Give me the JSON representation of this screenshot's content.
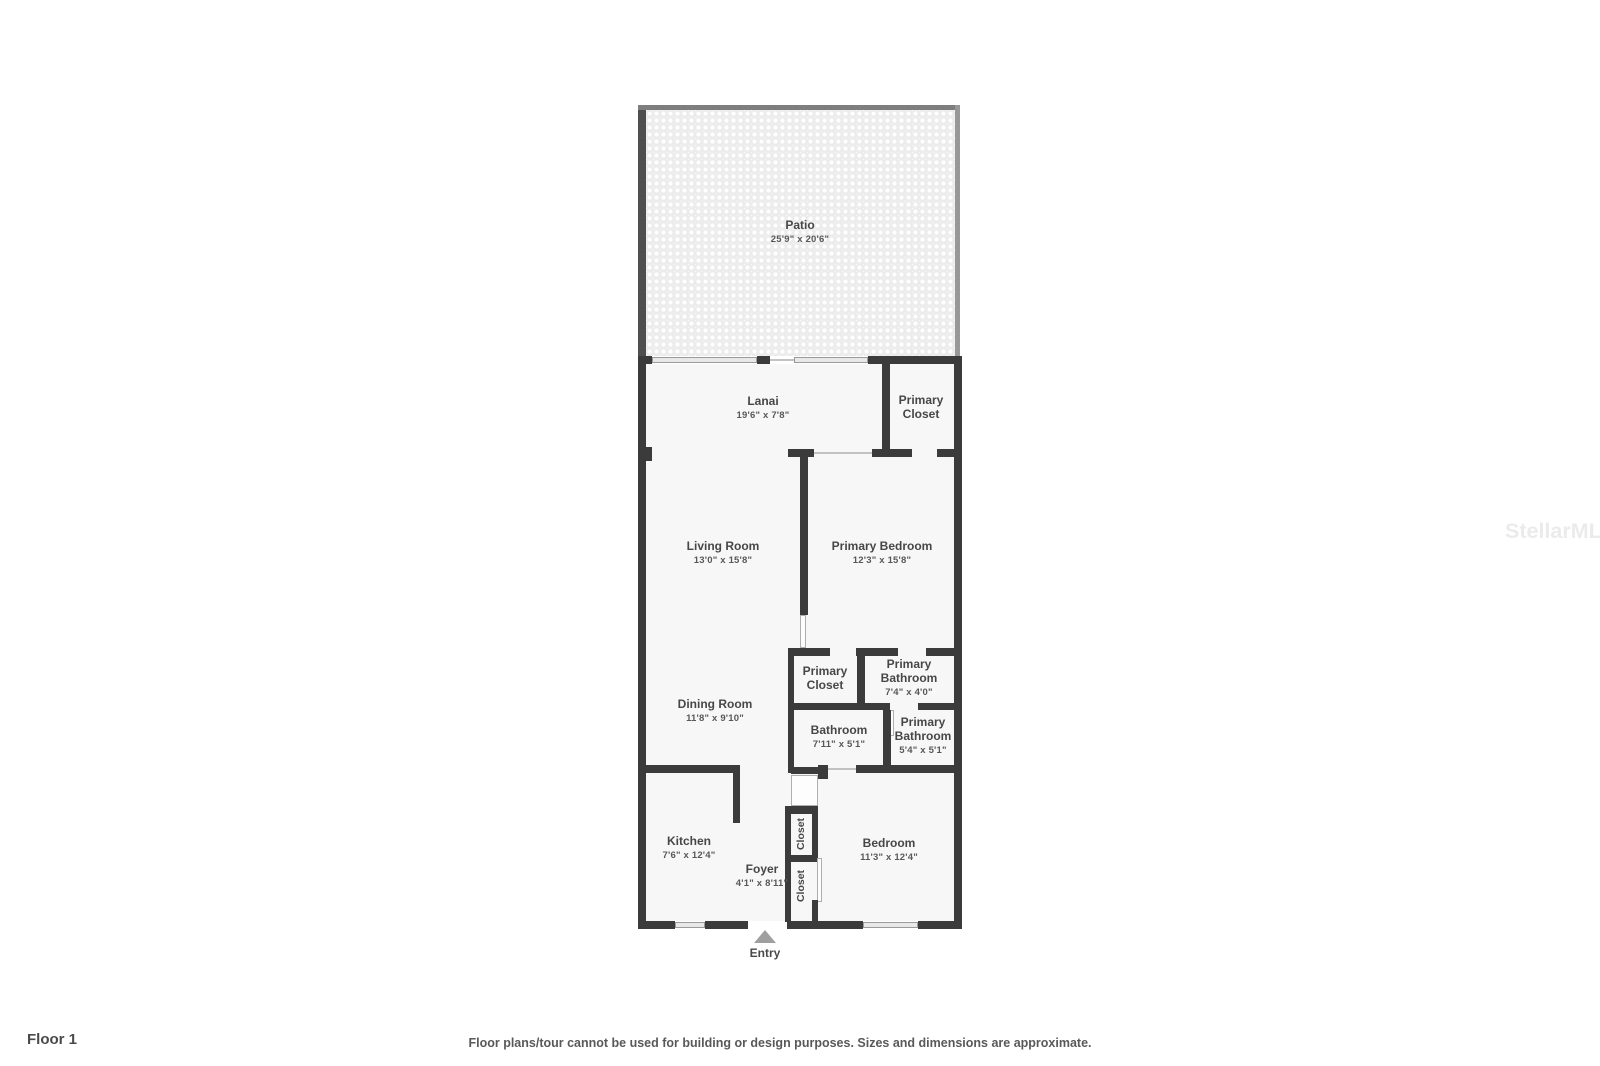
{
  "floor_label": "Floor 1",
  "disclaimer": "Floor plans/tour cannot be used for building or design purposes. Sizes and dimensions are approximate.",
  "watermark": "StellarMLS",
  "entry": {
    "label": "Entry"
  },
  "rooms": {
    "patio": {
      "name": "Patio",
      "dims": "25'9\" x 20'6\""
    },
    "lanai": {
      "name": "Lanai",
      "dims": "19'6\" x 7'8\""
    },
    "primary_closet_upper": {
      "name": "Primary Closet"
    },
    "living_room": {
      "name": "Living Room",
      "dims": "13'0\" x 15'8\""
    },
    "primary_bedroom": {
      "name": "Primary Bedroom",
      "dims": "12'3\" x 15'8\""
    },
    "primary_closet_lower": {
      "name": "Primary Closet"
    },
    "primary_bathroom_upper": {
      "name": "Primary Bathroom",
      "dims": "7'4\" x 4'0\""
    },
    "dining_room": {
      "name": "Dining Room",
      "dims": "11'8\" x 9'10\""
    },
    "bathroom": {
      "name": "Bathroom",
      "dims": "7'11\" x 5'1\""
    },
    "primary_bathroom_lower": {
      "name": "Primary Bathroom",
      "dims": "5'4\" x 5'1\""
    },
    "kitchen": {
      "name": "Kitchen",
      "dims": "7'6\" x 12'4\""
    },
    "foyer": {
      "name": "Foyer",
      "dims": "4'1\" x 8'11\""
    },
    "closet_upper": {
      "name": "Closet"
    },
    "closet_lower": {
      "name": "Closet"
    },
    "bedroom": {
      "name": "Bedroom",
      "dims": "11'3\" x 12'4\""
    }
  }
}
